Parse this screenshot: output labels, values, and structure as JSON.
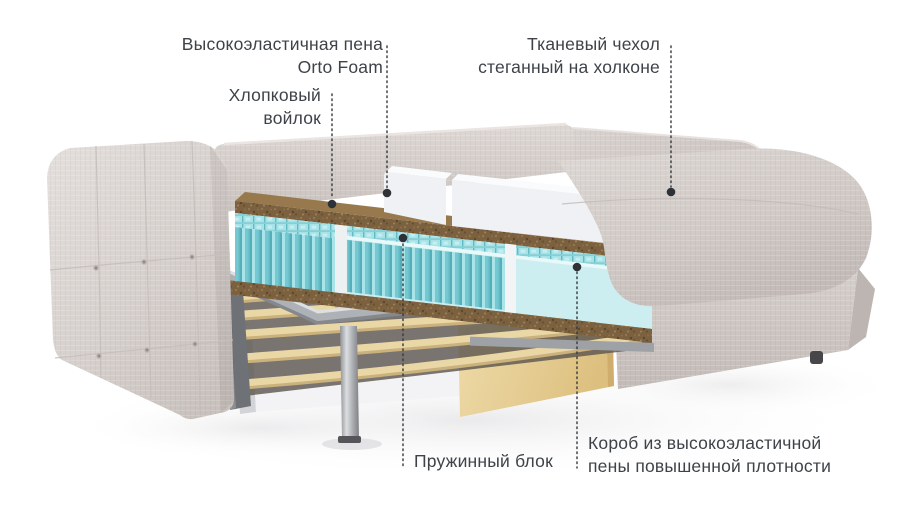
{
  "figure": {
    "type": "product-cutaway-diagram",
    "subject": "Диван-кровать в разрезе: слои матраса и механизм трансформации",
    "background": "#ffffff"
  },
  "callouts": {
    "orto_foam": {
      "line1": "Высокоэластичная пена",
      "line2": "Orto Foam"
    },
    "cotton_felt": {
      "line1": "Хлопковый",
      "line2": "войлок"
    },
    "fabric_cover": {
      "line1": "Тканевый чехол",
      "line2": "стеганный на холконе"
    },
    "spring_block": {
      "line1": "Пружинный блок"
    },
    "foam_box": {
      "line1": "Короб из высокоэластичной",
      "line2": "пены повышенной плотности"
    }
  },
  "palette": {
    "page_bg": "#ffffff",
    "text_color": "#3e4349",
    "leader_color": "#34383d",
    "fabric_light": "#e0dbd8",
    "fabric_mid": "#d3ccc9",
    "fabric_dark": "#c2bab6",
    "foam_white": "#eff1f4",
    "felt_brown": "#7c6140",
    "spring_teal": "#74c8d1",
    "spring_teal_light": "#a9e4e9",
    "foam_box_blue": "#cdeef0",
    "wood_slat": "#ead7a6",
    "wood_panel": "#e8d09c",
    "metal_gray": "#aeb1b5",
    "base_white": "#f3f3f5"
  }
}
